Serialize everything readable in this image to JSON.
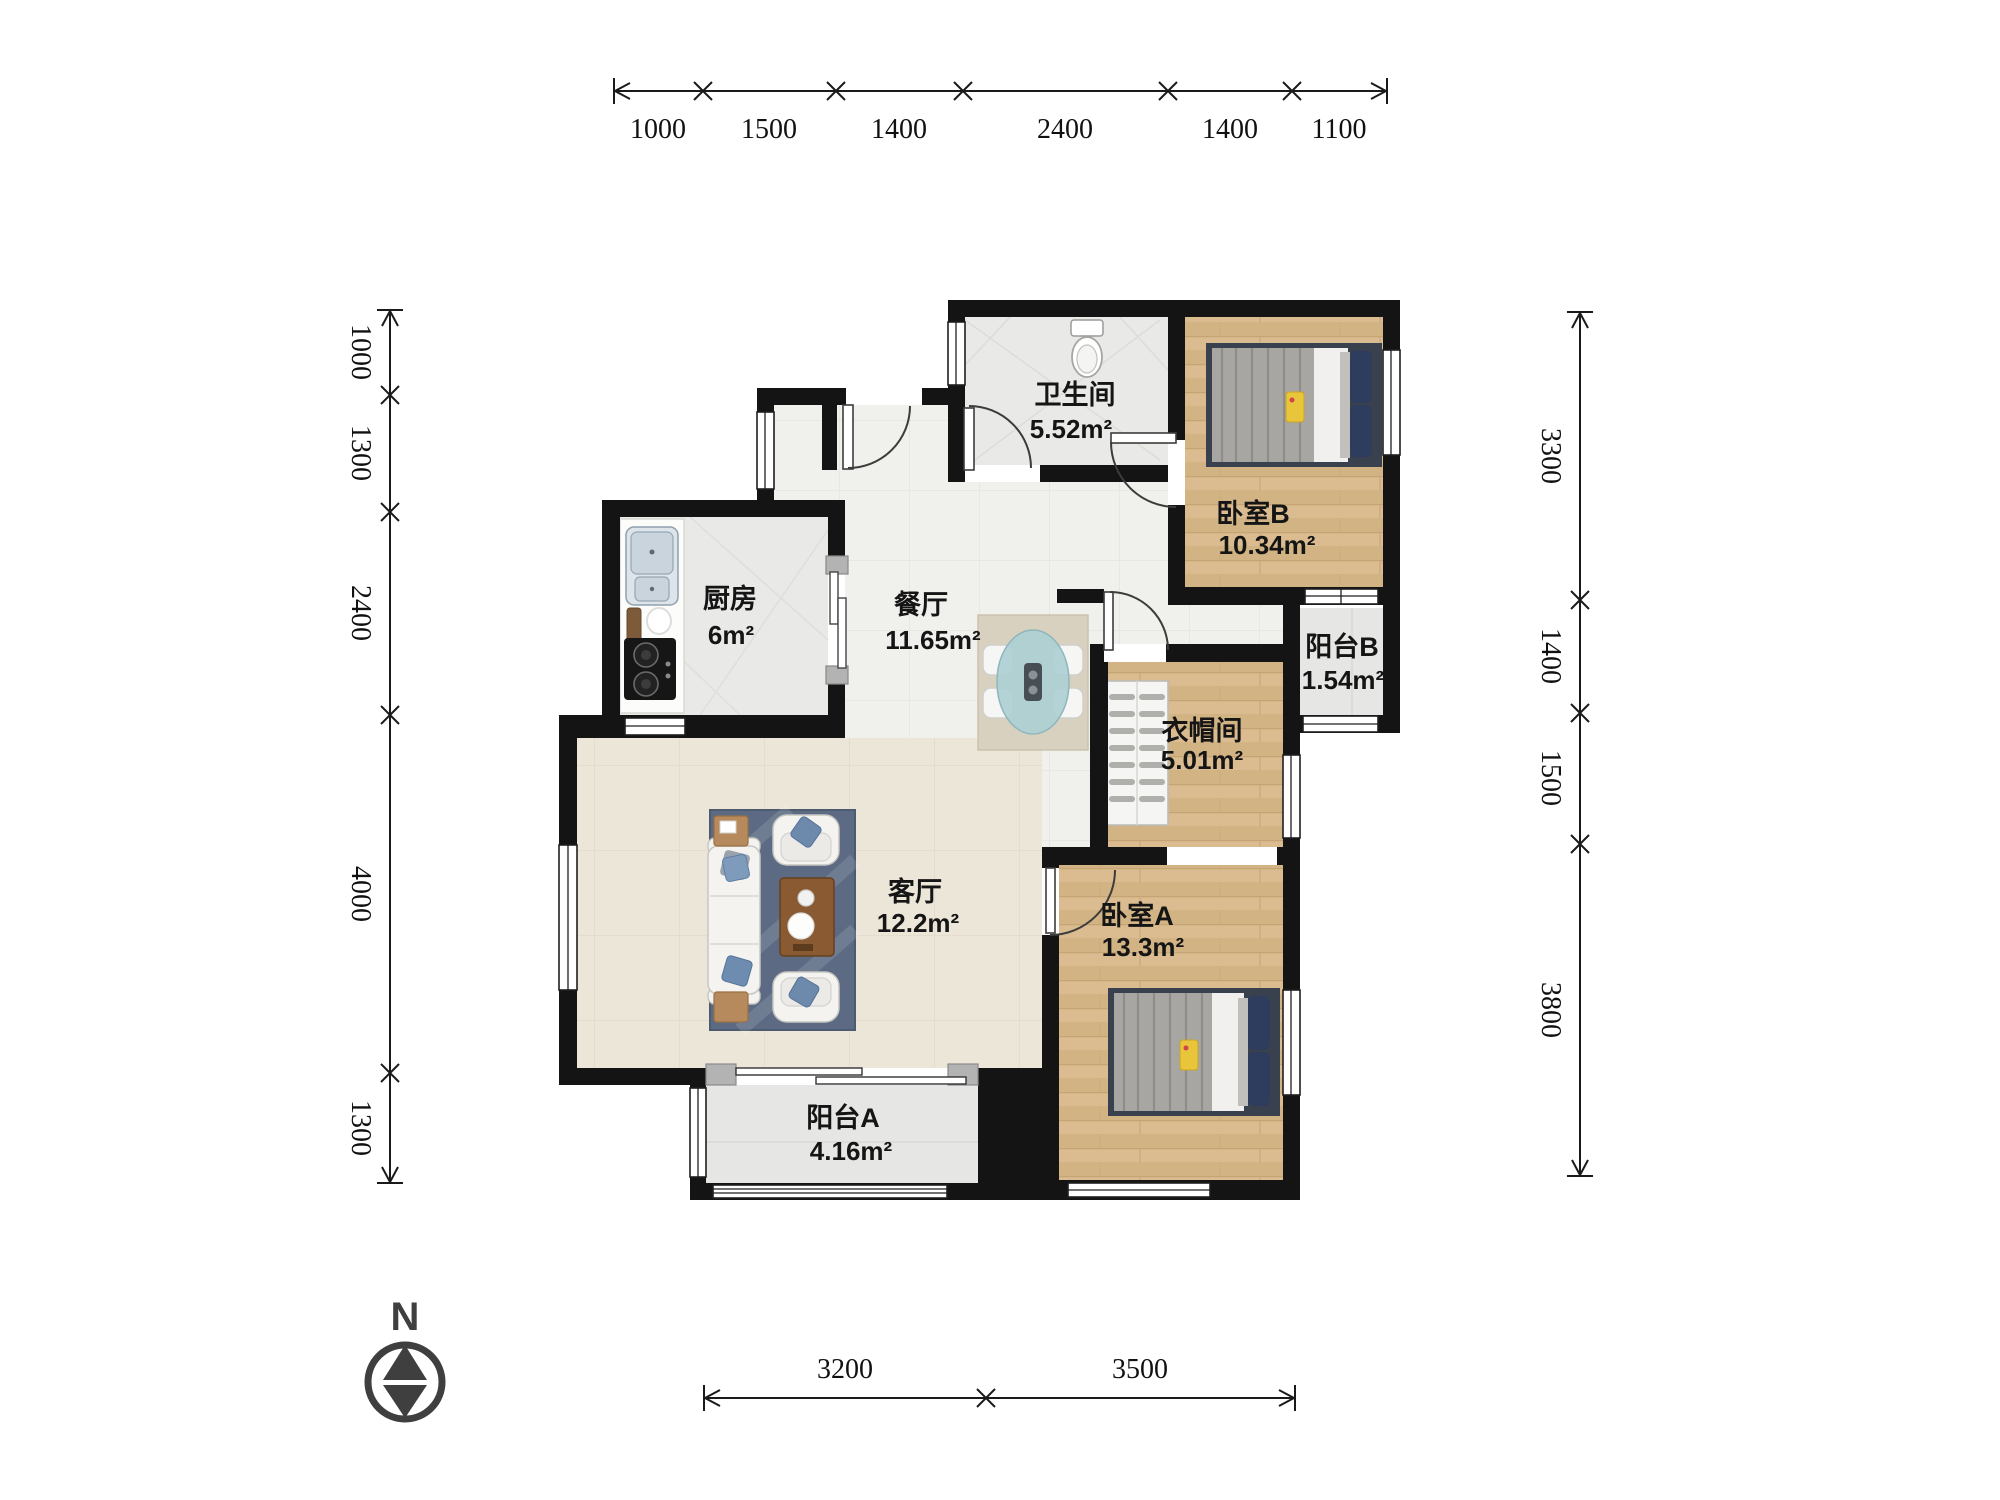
{
  "compass": {
    "label": "N"
  },
  "rooms": [
    {
      "key": "bathroom",
      "name": "卫生间",
      "area": "5.52m²"
    },
    {
      "key": "bedroom_b",
      "name": "卧室B",
      "area": "10.34m²"
    },
    {
      "key": "kitchen",
      "name": "厨房",
      "area": "6m²"
    },
    {
      "key": "dining",
      "name": "餐厅",
      "area": "11.65m²"
    },
    {
      "key": "balcony_b",
      "name": "阳台B",
      "area": "1.54m²"
    },
    {
      "key": "cloakroom",
      "name": "衣帽间",
      "area": "5.01m²"
    },
    {
      "key": "living",
      "name": "客厅",
      "area": "12.2m²"
    },
    {
      "key": "bedroom_a",
      "name": "卧室A",
      "area": "13.3m²"
    },
    {
      "key": "balcony_a",
      "name": "阳台A",
      "area": "4.16m²"
    }
  ],
  "dimensions": {
    "top": [
      "1000",
      "1500",
      "1400",
      "2400",
      "1400",
      "1100"
    ],
    "left": [
      "1000",
      "1300",
      "2400",
      "4000",
      "1300"
    ],
    "right": [
      "3300",
      "1400",
      "1500",
      "3800"
    ],
    "bottom": [
      "3200",
      "3500"
    ]
  },
  "colors": {
    "wall": "#141414",
    "wood_floor": "#d9bb90",
    "tile_floor": "#e9e9e7",
    "hall_floor": "#f0f0ed",
    "living_floor": "#ece6d9",
    "accent_navy": "#2e3c5e",
    "accent_yellow": "#e8c53a"
  }
}
